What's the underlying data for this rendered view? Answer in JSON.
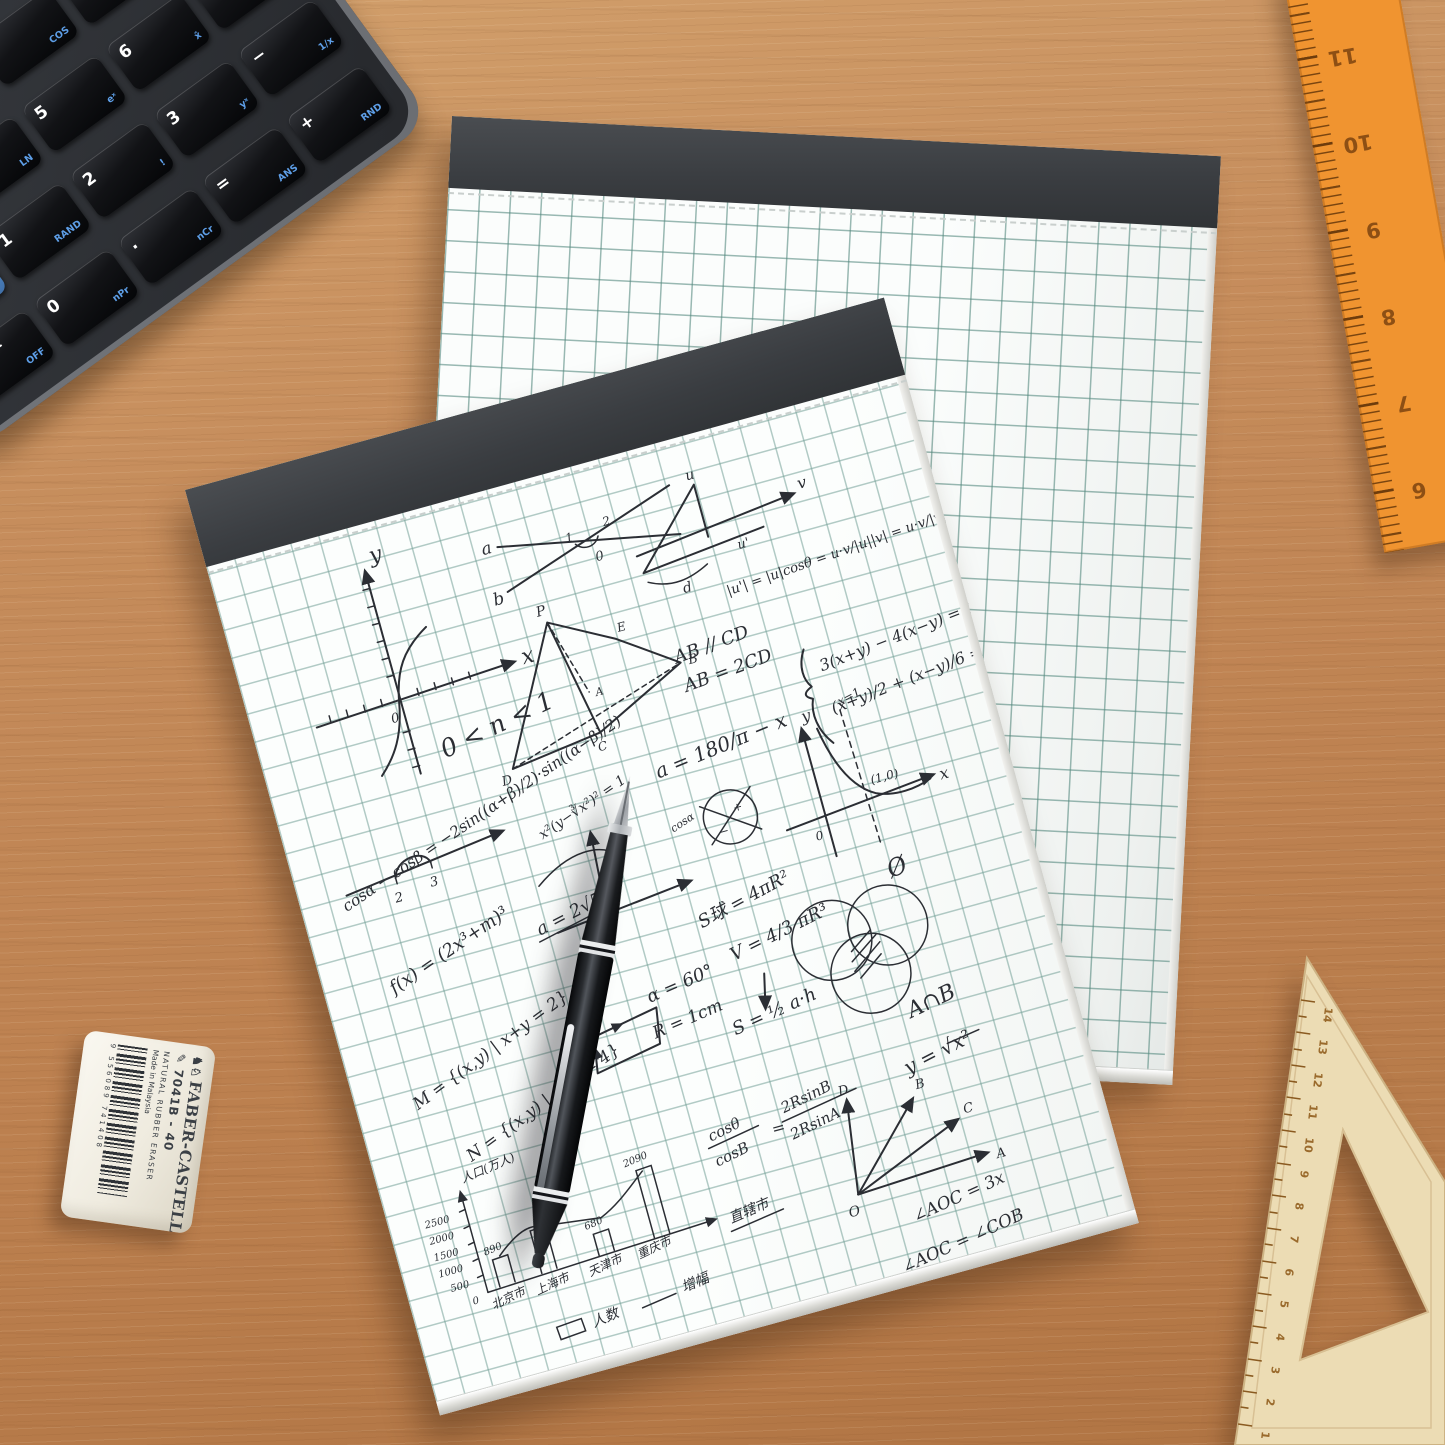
{
  "scene": {
    "description": "Two grid-paper notepads on a wooden desk with a financial calculator, black pen, Faber-Castell eraser, orange ruler and wooden set square"
  },
  "calculator": {
    "display_color": "#cfe7d0",
    "accent_blue": "#5e9fe8",
    "rows": [
      {
        "keys": [
          {
            "label": "N",
            "sub": "xP/YR"
          },
          {
            "label": "I/YR",
            "sub": "ICnv"
          },
          {
            "label": "PV",
            "sub": "Beg"
          },
          {
            "label": "PMT",
            "sub": "P/YR"
          },
          {
            "label": "FV",
            "sub": "End"
          },
          {
            "label": "Amort",
            "sub": "Depr"
          }
        ]
      },
      {
        "keys": [
          {
            "label": "CshFl",
            "sub": "Data"
          },
          {
            "label": "IRR",
            "sub": "Stats"
          },
          {
            "label": "NPV",
            "sub": "BrkEv"
          },
          {
            "label": "Bond",
            "sub": "Date"
          },
          {
            "label": "%",
            "sub": "% calc"
          },
          {
            "label": "RCL",
            "sub": "STO"
          }
        ]
      },
      {
        "keys": [
          {
            "label": "INPUT",
            "sub": "Memory"
          },
          {
            "label": "(",
            "sub": ""
          },
          {
            "label": ")",
            "sub": ""
          },
          {
            "label": "+/-",
            "sub": "EEX"
          },
          {
            "label": "←",
            "sub": "Reset"
          }
        ]
      },
      {
        "keys": [
          {
            "label": "▲",
            "sub": "RG"
          },
          {
            "label": "7",
            "sub": "SIN"
          },
          {
            "label": "8",
            "sub": "COS"
          },
          {
            "label": "9",
            "sub": "TAN"
          },
          {
            "label": "÷",
            "sub": "Math"
          }
        ]
      },
      {
        "keys": [
          {
            "label": "▼",
            "sub": "DEL"
          },
          {
            "label": "4",
            "sub": "LN"
          },
          {
            "label": "5",
            "sub": "eˣ"
          },
          {
            "label": "6",
            "sub": "x̂"
          },
          {
            "label": "×",
            "sub": "√"
          }
        ]
      },
      {
        "keys": [
          {
            "label": "",
            "sub": ""
          },
          {
            "label": "1",
            "sub": "RAND"
          },
          {
            "label": "2",
            "sub": "!"
          },
          {
            "label": "3",
            "sub": "yˣ"
          },
          {
            "label": "−",
            "sub": "1/x"
          }
        ]
      },
      {
        "keys": [
          {
            "label": "ON/CE",
            "sub": "OFF"
          },
          {
            "label": "0",
            "sub": "nPr"
          },
          {
            "label": "·",
            "sub": "nCr"
          },
          {
            "label": "=",
            "sub": "ANS"
          },
          {
            "label": "+",
            "sub": "RND"
          }
        ]
      }
    ]
  },
  "handwriting": {
    "axes1": {
      "x": "x",
      "y": "y",
      "o": "0"
    },
    "cross": {
      "a": "a",
      "b": "b",
      "n1": "1",
      "n2": "2",
      "o": "0"
    },
    "vect": {
      "u": "u",
      "v": "v",
      "uprime": "u'",
      "d": "d",
      "formula": "|u'| = |u|cosθ = u·v/|u||v| = u·v/|v|"
    },
    "tetra": {
      "p": "P",
      "a": "A",
      "b": "B",
      "c": "C",
      "d": "D",
      "e": "E"
    },
    "parallel1": "AB // CD",
    "parallel2": "AB = 2CD",
    "sys1": "3(x+y) − 4(x−y) = 4",
    "sys2": "(x+y)/2 + (x−y)/6 = 1",
    "ineq": "0 < n < 1",
    "cosid": "cosα − cosβ = −2sin((α+β)/2)·sin((α−β)/2)",
    "curveeq": "x²(y−∛x²)² = 1",
    "alphaeq": "a = 180/π − x",
    "graph2": {
      "y": "y",
      "x": "x",
      "o": "0",
      "pt": "(1,0)",
      "asym": "x=1"
    },
    "cosalpha": "cosα",
    "plus": "+",
    "minus": "−",
    "int2": "2",
    "int3": "3",
    "fx": "f(x) = (2x³+m)³",
    "a25": "a = 2√5",
    "setM": "M = {(x,y) | x+y = 2}",
    "setN": "N = {(x,y) | x−y = 4}",
    "alpha60": "α = 60°",
    "r1": "R = 1cm",
    "ssphere": "S球 = 4πR²",
    "vsphere": "V = 4/3 πR³",
    "sarea": "S = ½ a·h",
    "empty": "Ø",
    "anb": "A∩B",
    "ysqrt": "y = √x²",
    "rays": {
      "o": "O",
      "a": "A",
      "b": "B",
      "c": "C",
      "d": "D"
    },
    "ang1": "∠AOC = 3x",
    "ang2": "∠AOC = ∠COB",
    "fr1n": "cosθ",
    "fr1d": "cosB",
    "eq": "=",
    "fr2n": "2RsinB",
    "fr2d": "2RsinA"
  },
  "chart_data": {
    "type": "bar",
    "title": "",
    "ylabel": "人口(万人)",
    "xlabel": "直辖市",
    "categories": [
      "北京市",
      "上海市",
      "天津市",
      "重庆市"
    ],
    "values": [
      890,
      null,
      680,
      2090
    ],
    "yticks": [
      0,
      500,
      1000,
      1500,
      2000,
      2500
    ],
    "ylim": [
      0,
      2500
    ],
    "legend": [
      {
        "label": "人数",
        "type": "bar"
      },
      {
        "label": "增幅",
        "type": "line"
      }
    ]
  },
  "eraser": {
    "brand": "FABER-CASTELL",
    "knights_icon": "♞♘",
    "pencil_icon": "✎",
    "model": "7041B - 40",
    "material": "NATURAL RUBBER ERASER",
    "origin": "Made in Malaysia",
    "barcode": "9 556089 741408"
  },
  "ruler": {
    "numbers": [
      "12",
      "11",
      "10",
      "9",
      "8",
      "7",
      "6"
    ]
  },
  "set_square": {
    "numbers": [
      "14",
      "13",
      "12",
      "11",
      "10",
      "9",
      "8",
      "7",
      "6",
      "5",
      "4",
      "3",
      "2",
      "1"
    ]
  }
}
